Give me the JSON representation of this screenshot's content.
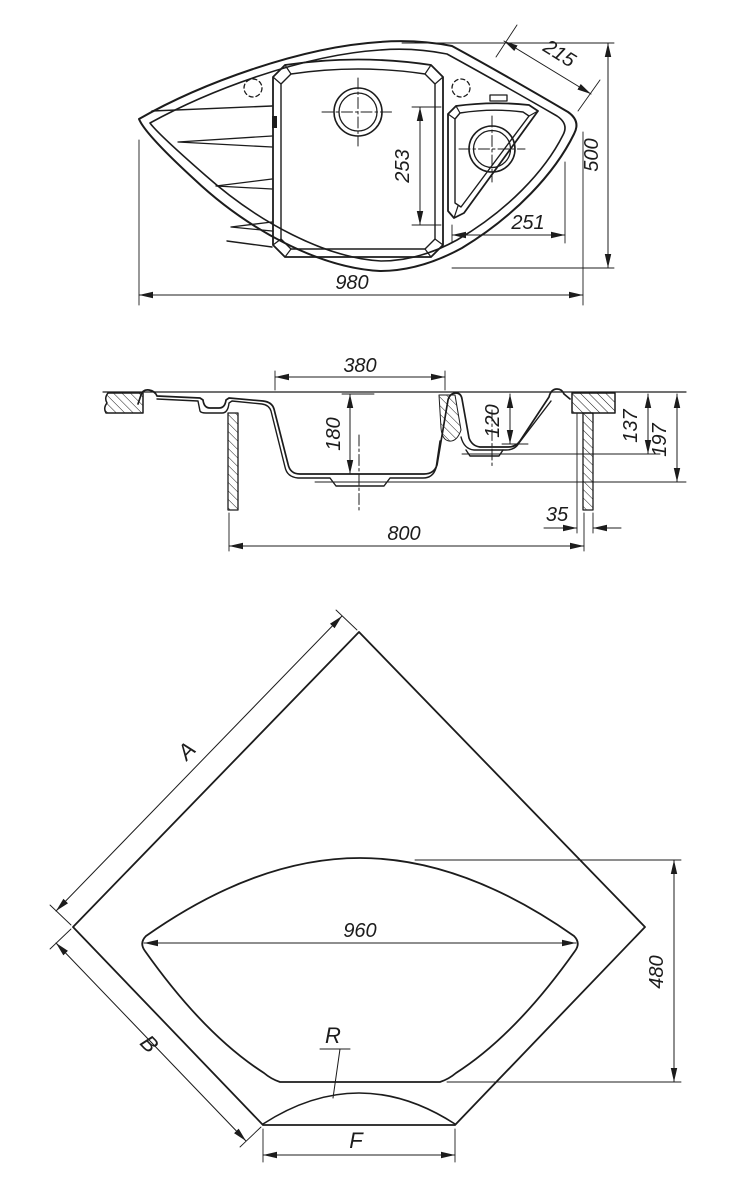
{
  "drawing_title": "corner-sink-technical-drawing",
  "colors": {
    "ink": "#1c1c1c",
    "background": "#ffffff"
  },
  "views": {
    "top": {
      "dims": {
        "overall_width": "980",
        "overall_depth": "500",
        "corner_edge": "215",
        "main_basin_length": "253",
        "right_basin_width": "251"
      }
    },
    "section": {
      "dims": {
        "main_basin_width": "380",
        "main_basin_depth": "180",
        "small_basin_depth": "120",
        "small_bottom_height": "137",
        "main_bottom_height": "197",
        "side_offset": "35",
        "base_width": "800"
      }
    },
    "cutout": {
      "dims": {
        "edge_a": "A",
        "edge_b": "B",
        "cutout_width": "960",
        "cutout_depth": "480",
        "front_edge": "F",
        "front_radius": "R"
      }
    }
  }
}
